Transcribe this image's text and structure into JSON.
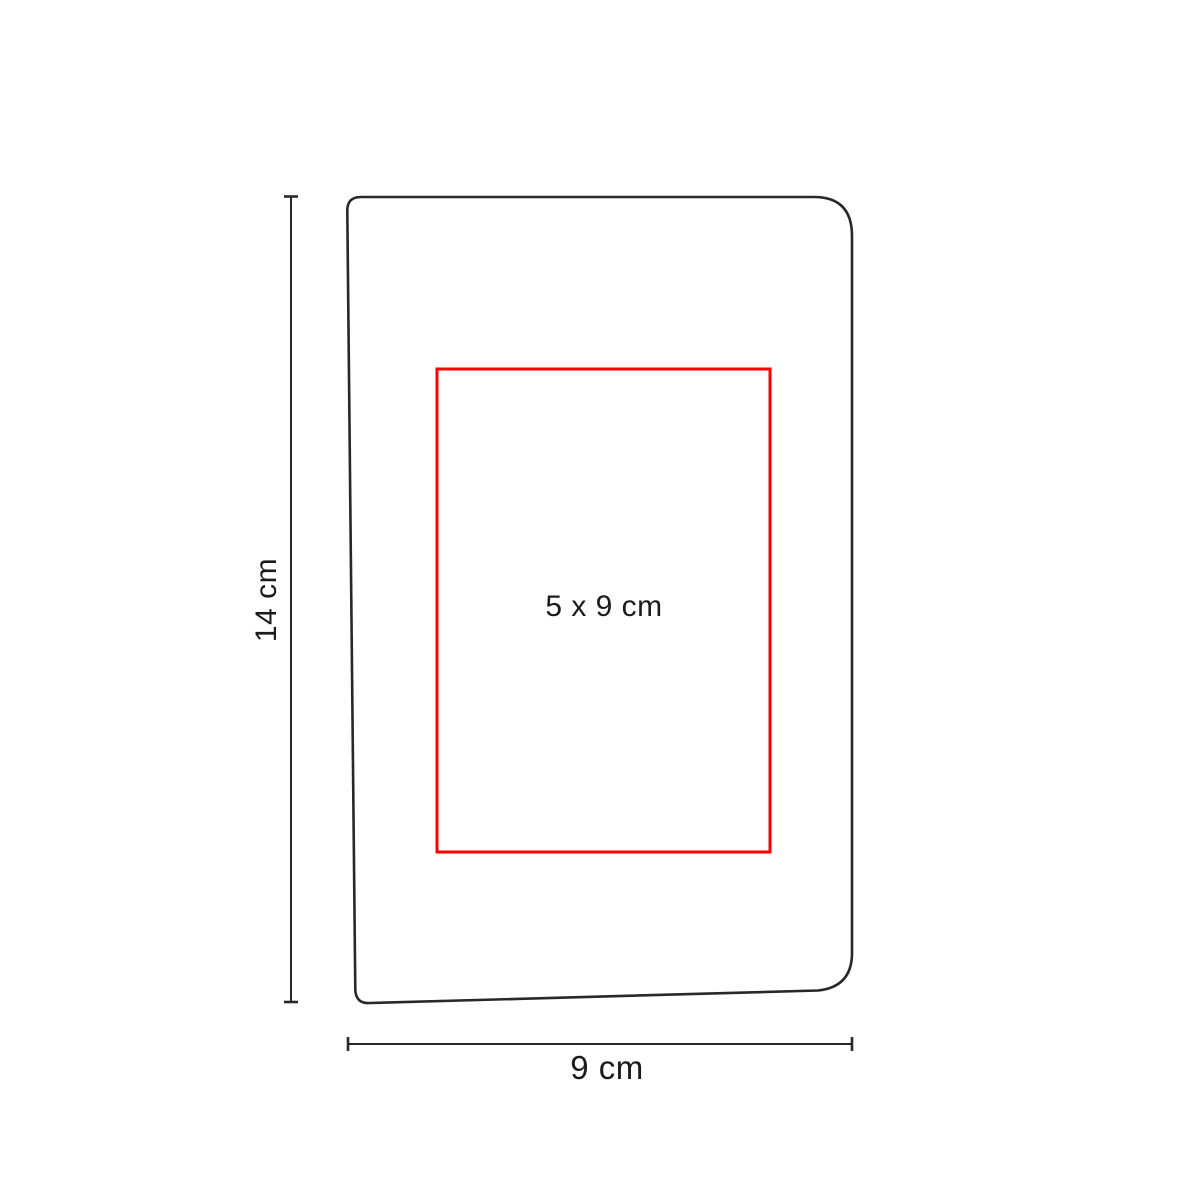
{
  "diagram": {
    "height_label": "14 cm",
    "width_label": "9 cm",
    "print_area_label": "5 x 9 cm",
    "colors": {
      "outline": "#2a2728",
      "print_area_border": "#ff0000",
      "dimension_line": "#2a2728",
      "text": "#1c1a1b",
      "background": "#ffffff"
    }
  }
}
